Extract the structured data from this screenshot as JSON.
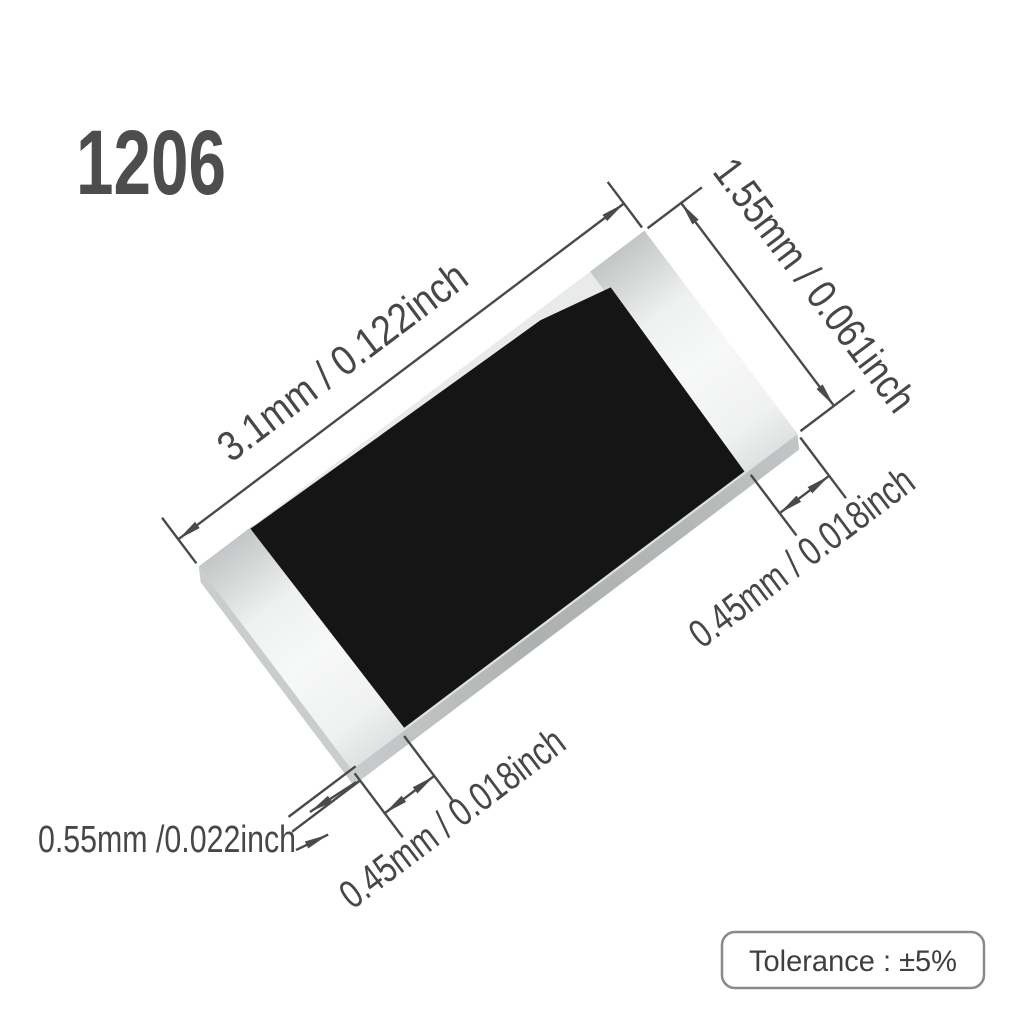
{
  "labels": {
    "package_size": "1206",
    "tolerance": "Tolerance : ±5%"
  },
  "dimensions": {
    "length": "3.1mm / 0.122inch",
    "width": "1.55mm / 0.061inch",
    "right_terminal": "0.45mm / 0.018inch",
    "bottom_terminal": "0.45mm / 0.018inch",
    "thickness": "0.55mm /0.022inch"
  },
  "colors": {
    "body": "#151515",
    "cap_light": "#f2f3f3",
    "cap_shadow": "#c3c6c6",
    "substrate": "#e9ebeb",
    "side_face": "#b2b5b5",
    "dimension_lines": "#4a4a4a",
    "text": "#474747",
    "badge_border": "#8a8a8a"
  }
}
